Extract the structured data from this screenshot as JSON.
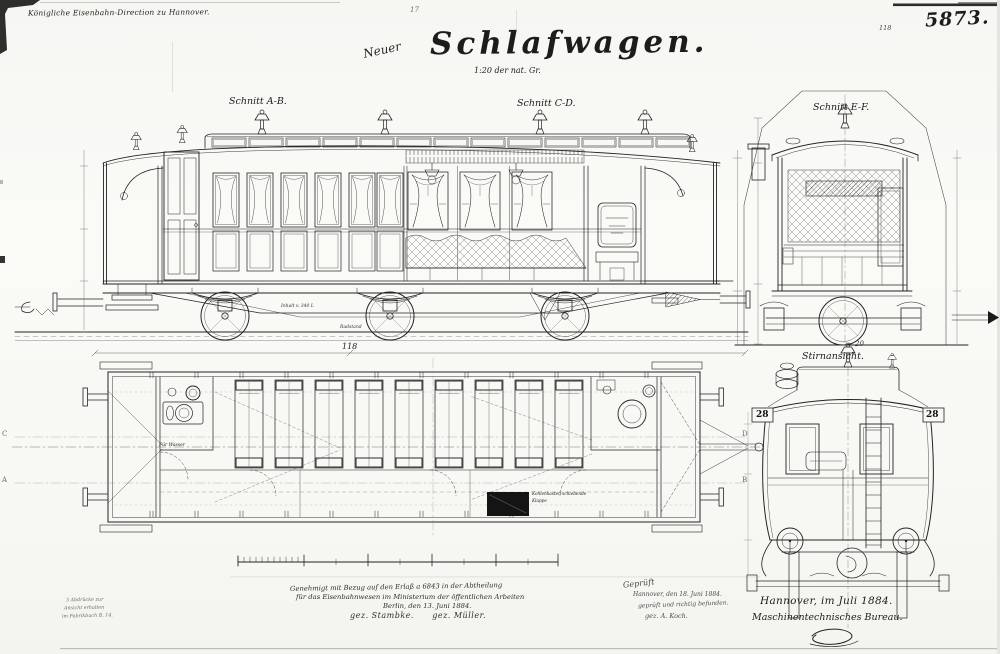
{
  "colors": {
    "ink": "#1c1c1c",
    "paper": "#f9f9f6",
    "pencil": "#4a4a4a"
  },
  "header": {
    "direction_note": "Königliche Eisenbahn-Direction zu Hannover.",
    "corner_mark": "17",
    "sheet_number": "5873.",
    "sheet_number_small": "118"
  },
  "title": {
    "prefix": "Neuer",
    "main": "Schlafwagen.",
    "scale": "1:20 der nat. Gr."
  },
  "view_labels": {
    "section_ab": "Schnitt A-B.",
    "section_cd": "Schnitt C-D.",
    "section_ef": "Schnitt E-F.",
    "end_view": "Stirnansicht.",
    "end_view_number": "20"
  },
  "elevation_labels": {
    "length_dim": "118",
    "tank": "Inhalt v. 340 L",
    "wheelbase": "Radstand"
  },
  "plan_labels": {
    "water": "Für Wasser",
    "coal_flap_line1": "Kohlenkasten-schiebende",
    "coal_flap_line2": "Klappe",
    "section_marker_c": "C",
    "section_marker_a": "A",
    "section_marker_d": "D",
    "section_marker_b": "B"
  },
  "end_view_labels": {
    "car_number_left": "28",
    "car_number_right": "28"
  },
  "approval": {
    "line1": "Genehmigt mit Bezug auf den Erlaß a 6843 in der Abtheilung",
    "line2": "für das Eisenbahnwesen im Ministerium der öffentlichen Arbeiten",
    "line3": "Berlin, den 13. Juni 1884.",
    "signatures": "gez. Stambke.      gez. Müller."
  },
  "inspection": {
    "line1": "Geprüft",
    "line2": "Hannover, den 18. Juni 1884.",
    "line3": "geprüft und richtig befunden.",
    "line4": "gez. A. Koch."
  },
  "issuance": {
    "place_date": "Hannover, im Juli 1884.",
    "bureau": "Maschinentechnisches Bureau."
  },
  "margin_notes": {
    "line1": "3 Abdrücke zur",
    "line2": "Ansicht erhalten",
    "line3": "im Fabrikbuch B. 14."
  }
}
